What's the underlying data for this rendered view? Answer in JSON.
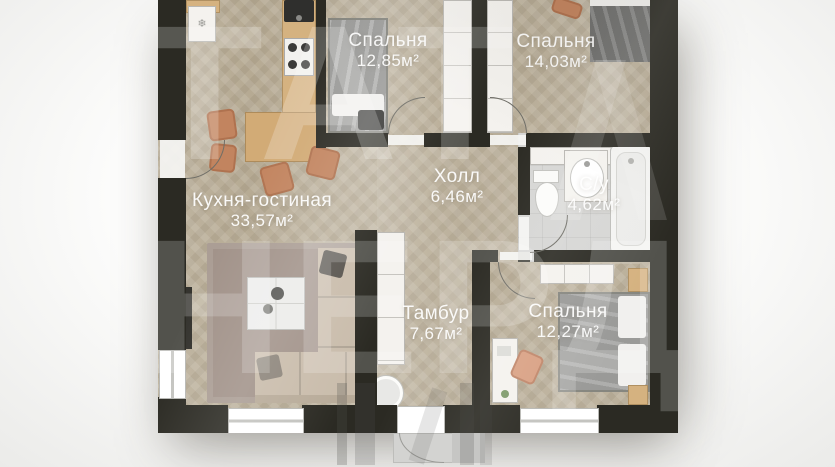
{
  "plan": {
    "title": "Floor plan",
    "watermark": {
      "line1": "ТАТ",
      "line2": "НЕРД"
    },
    "rooms": [
      {
        "name": "Кухня-гостиная",
        "area": "33,57м²"
      },
      {
        "name": "Спальня",
        "area": "12,85м²"
      },
      {
        "name": "Спальня",
        "area": "14,03м²"
      },
      {
        "name": "Холл",
        "area": "6,46м²"
      },
      {
        "name": "С/у",
        "area": "4,62м²"
      },
      {
        "name": "Тамбур",
        "area": "7,67м²"
      },
      {
        "name": "Спальня",
        "area": "12,27м²"
      }
    ],
    "icons": {
      "fridge": "snowflake-icon"
    },
    "colors": {
      "wall": "#2b2a23",
      "floor_wood": "#b6aa93",
      "floor_tile": "#d6d6d4",
      "accent_wood": "#d5b280",
      "accent_terracotta": "#c2845f",
      "label_text": "#ffffff",
      "background": "#f5f5f4"
    }
  }
}
